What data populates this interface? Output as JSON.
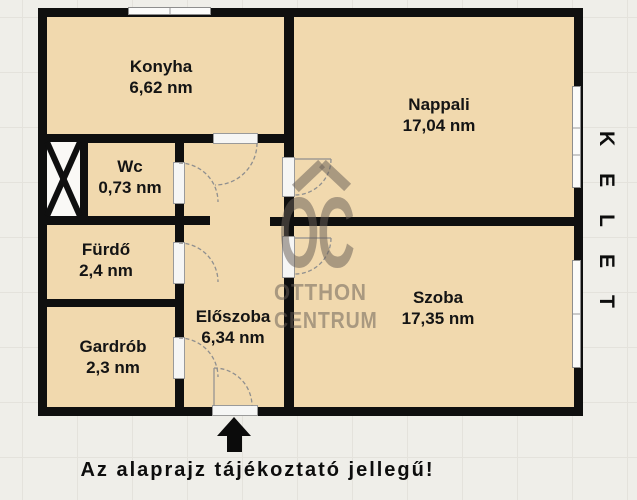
{
  "floorplan": {
    "rooms": [
      {
        "name": "Konyha",
        "area": "6,62 nm"
      },
      {
        "name": "Nappali",
        "area": "17,04 nm"
      },
      {
        "name": "Wc",
        "area": "0,73 nm"
      },
      {
        "name": "Fürdő",
        "area": "2,4 nm"
      },
      {
        "name": "Gardrób",
        "area": "2,3 nm"
      },
      {
        "name": "Előszoba",
        "area": "6,34 nm"
      },
      {
        "name": "Szoba",
        "area": "17,35 nm"
      }
    ],
    "compass_label": "KELET",
    "caption": "Az alaprajz tájékoztató jellegű!",
    "watermark": {
      "logo_text": "OC",
      "line1": "OTTHON",
      "line2": "CENTRUM"
    },
    "colors": {
      "wall": "#0f0f0f",
      "room_fill": "#f1d9ae",
      "background": "#efeee9",
      "watermark": "#675d56",
      "window_frame": "#8e8e8e"
    }
  }
}
